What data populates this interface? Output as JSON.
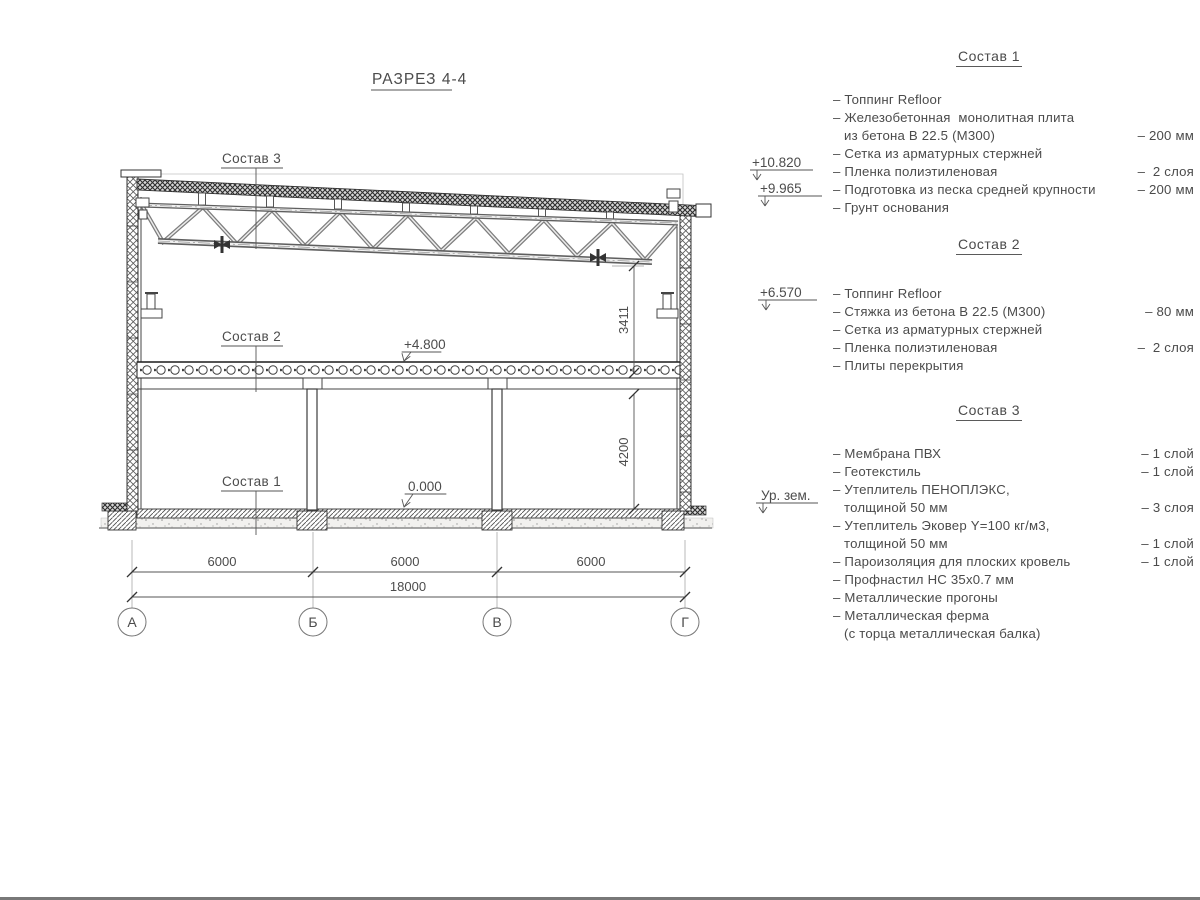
{
  "title": "РАЗРЕЗ 4-4",
  "drawing": {
    "callouts": {
      "s3": "Состав 3",
      "s2": "Состав 2",
      "s1": "Состав 1"
    },
    "levels": {
      "parapet": "+10.820",
      "roof": "+9.965",
      "bracket": "+6.570",
      "floor2": "+4.800",
      "floor0": "0.000",
      "ground": "Ур. зем."
    },
    "dims": {
      "bay1": "6000",
      "bay2": "6000",
      "bay3": "6000",
      "total": "18000",
      "truss_h": "3411",
      "floor_h": "4200"
    },
    "axes": [
      "А",
      "Б",
      "В",
      "Г"
    ]
  },
  "sections": [
    {
      "heading": "Состав 1",
      "items": [
        {
          "text": "– Топпинг Refloor"
        },
        {
          "text": "– Железобетонная  монолитная плита"
        },
        {
          "text": "из бетона В 22.5 (М300)",
          "value": "– 200 мм",
          "cont": true
        },
        {
          "text": "– Сетка из арматурных стержней"
        },
        {
          "text": "– Пленка полиэтиленовая",
          "value": "–  2 слоя"
        },
        {
          "text": "– Подготовка из песка средней крупности",
          "value": "– 200 мм"
        },
        {
          "text": "– Грунт основания"
        }
      ]
    },
    {
      "heading": "Состав 2",
      "items": [
        {
          "text": "– Топпинг Refloor"
        },
        {
          "text": "– Стяжка из бетона В 22.5 (М300)",
          "value": "– 80 мм"
        },
        {
          "text": "– Сетка из арматурных стержней"
        },
        {
          "text": "– Пленка полиэтиленовая",
          "value": "–  2 слоя"
        },
        {
          "text": "– Плиты перекрытия"
        }
      ]
    },
    {
      "heading": "Состав 3",
      "items": [
        {
          "text": "– Мембрана ПВХ",
          "value": "– 1 слой"
        },
        {
          "text": "– Геотекстиль",
          "value": "– 1 слой"
        },
        {
          "text": "– Утеплитель ПЕНОПЛЭКС,"
        },
        {
          "text": "толщиной 50 мм",
          "value": "– 3 слоя",
          "cont": true
        },
        {
          "text": "– Утеплитель Эковер Y=100 кг/м3,"
        },
        {
          "text": "толщиной 50 мм",
          "value": "– 1 слой",
          "cont": true
        },
        {
          "text": "– Пароизоляция для плоских кровель",
          "value": "– 1 слой"
        },
        {
          "text": "– Профнастил НС 35х0.7 мм"
        },
        {
          "text": "– Металлические прогоны"
        },
        {
          "text": "– Металлическая ферма"
        },
        {
          "text": "(с торца металлическая балка)",
          "cont": true
        }
      ]
    }
  ]
}
